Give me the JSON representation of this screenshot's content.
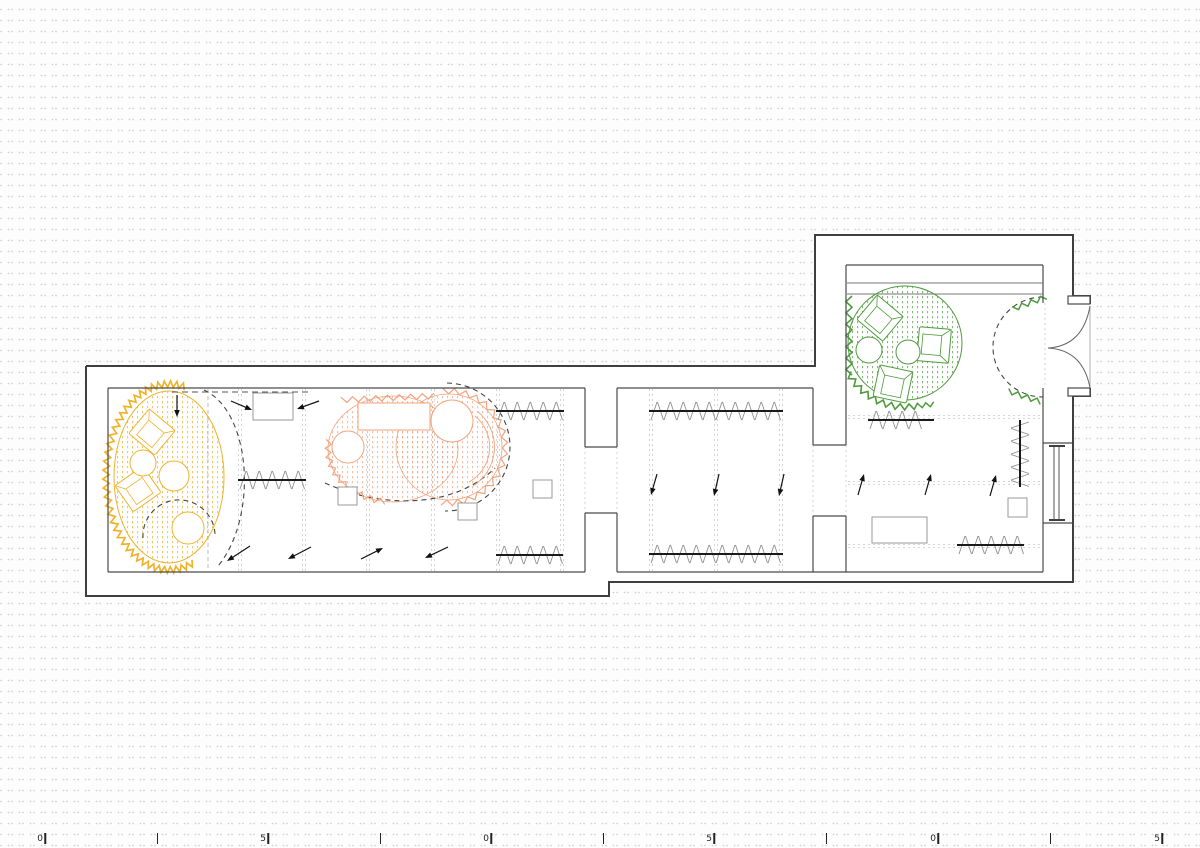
{
  "drawing": {
    "kind": "architectural floor plan",
    "visible_text_other_than_ruler": ""
  },
  "colors": {
    "yellow": "#EFB32A",
    "orange": "#F2A37E",
    "green": "#4D9B3C",
    "wall": "#3F3F3F",
    "wall_inner": "#4A4A4A",
    "beam": "#777777",
    "furniture_gray": "#9A9A9A",
    "gridline": "#C9C9C9",
    "grid_dark": "#ADADAD",
    "hedge": "#1A1A1A",
    "hedge_thin": "#8F8F8F",
    "dashed_dark": "#444444",
    "door_line": "#666666"
  },
  "ruler": {
    "ticks": [
      {
        "label": "0",
        "x": 44
      },
      {
        "label": "",
        "x": 156
      },
      {
        "label": "5",
        "x": 267
      },
      {
        "label": "",
        "x": 379
      },
      {
        "label": "0",
        "x": 490
      },
      {
        "label": "",
        "x": 602
      },
      {
        "label": "5",
        "x": 713
      },
      {
        "label": "",
        "x": 825
      },
      {
        "label": "0",
        "x": 937
      },
      {
        "label": "",
        "x": 1049
      },
      {
        "label": "5",
        "x": 1161
      }
    ]
  },
  "zones": [
    {
      "id": "zone-yellow",
      "color": "#EFB32A"
    },
    {
      "id": "zone-orange",
      "color": "#F2A37E"
    },
    {
      "id": "zone-green",
      "color": "#4D9B3C"
    }
  ]
}
